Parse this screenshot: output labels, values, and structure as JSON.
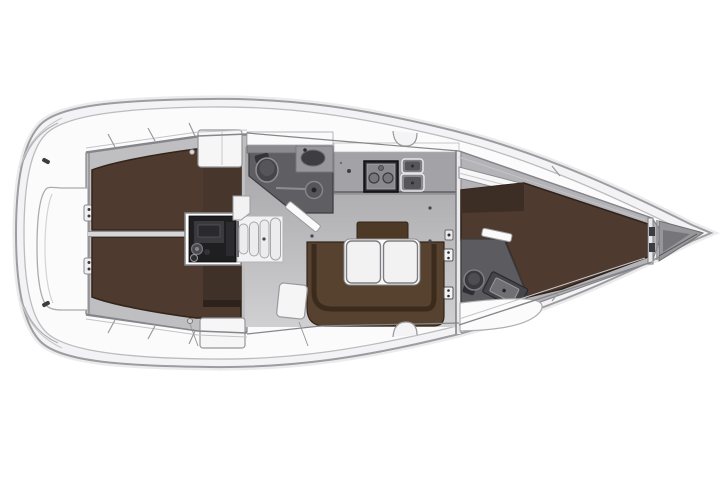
{
  "figure": {
    "kind": "yacht-interior-floor-plan",
    "view": "top-down",
    "orientation": "bow-right",
    "background": "#ffffff"
  },
  "colors": {
    "hull_outline": "#9d9da0",
    "hull_rim": "#f3f3f5",
    "hull_inner_line": "#bcbcbf",
    "deck_white": "#fbfbfc",
    "cabin_wall": "#85858a",
    "cabin_wall_light": "#c4c4c7",
    "cabin_floor": "#bfbfc2",
    "saloon_floor_dark": "#a4a4a8",
    "saloon_floor_light": "#d0d0d2",
    "berth_brown": "#4e3a2e",
    "berth_brown_edge": "#32251b",
    "berth_band_dark": "#3c2e24",
    "berth_side_dark": "#46362c",
    "sofa_brown": "#57422f",
    "sofa_line": "#3a2b1d",
    "backrest_brown": "#4e3927",
    "head_gray": "#5f5f63",
    "head_edge": "#3f3f42",
    "fixture_gray": "#46464a",
    "fixture_rim": "#8f8f93",
    "counter_gray": "#a3a3a7",
    "stove_dark": "#2b2b2f",
    "stove_panel": "#8a8a8e",
    "sink_gray": "#7e7e82",
    "sink_well": "#55555a",
    "engine_dark": "#1f1f22",
    "engine_detail": "#3a3a3e",
    "steps_white": "#ececee",
    "steps_edge": "#a6a6a9",
    "furniture_white": "#f6f6f7",
    "furniture_edge": "#97979a",
    "table_white": "#f2f2f3",
    "table_edge": "#7d7d81",
    "anchor_gray": "#97979b",
    "anchor_dark": "#75757a",
    "hardware_dark": "#3c3c40",
    "dot_dark": "#45454a"
  },
  "regions": [
    "stern-platform",
    "aft-cabin-port-berth",
    "aft-cabin-starboard-berth",
    "engine-compartment",
    "companionway-steps",
    "aft-head-bathroom",
    "galley",
    "saloon-settee",
    "saloon-table",
    "main-bulkhead",
    "forward-head-bathroom",
    "forward-v-berth",
    "anchor-locker"
  ]
}
